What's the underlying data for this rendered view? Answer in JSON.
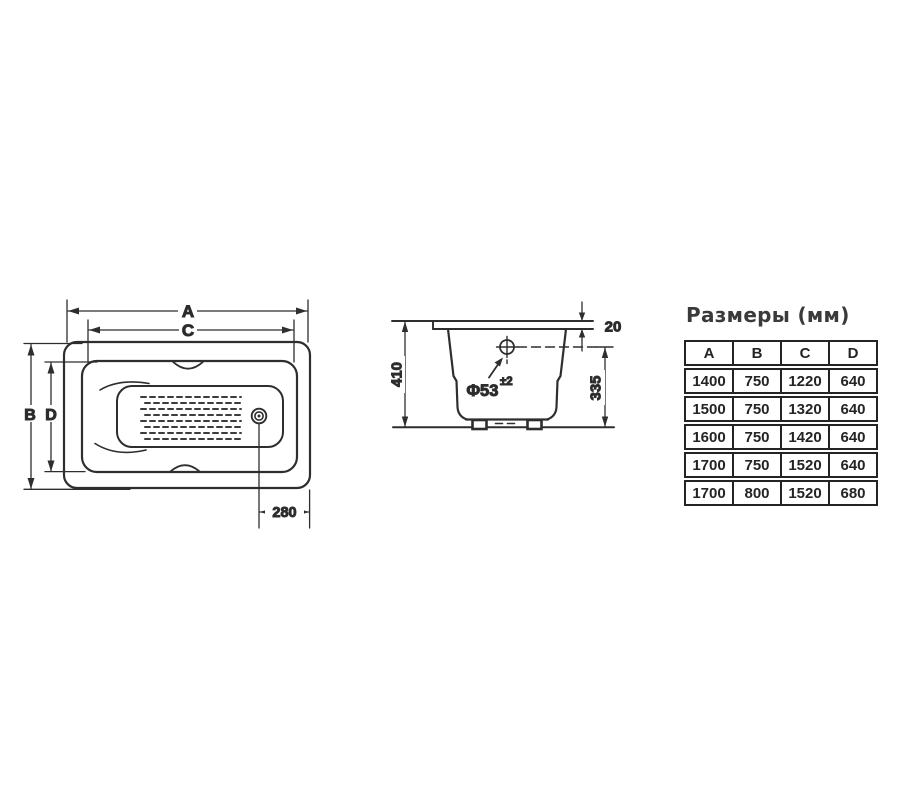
{
  "colors": {
    "ink": "#2e2e2e",
    "text": "#2b2b2b",
    "table_border": "#242424",
    "background": "#ffffff"
  },
  "top_view": {
    "label_a": "A",
    "label_c": "C",
    "label_b": "B",
    "label_d": "D",
    "dim_drain_to_edge": "280"
  },
  "section_view": {
    "dim_rim_thickness": "20",
    "dim_overall_height": "410",
    "dim_drain_center_height": "335",
    "drain_diameter": "Φ53",
    "drain_tolerance": "±2"
  },
  "size_table": {
    "title": "Размеры (мм)",
    "headers": [
      "A",
      "B",
      "C",
      "D"
    ],
    "rows": [
      [
        "1400",
        "750",
        "1220",
        "640"
      ],
      [
        "1500",
        "750",
        "1320",
        "640"
      ],
      [
        "1600",
        "750",
        "1420",
        "640"
      ],
      [
        "1700",
        "750",
        "1520",
        "640"
      ],
      [
        "1700",
        "800",
        "1520",
        "680"
      ]
    ]
  }
}
